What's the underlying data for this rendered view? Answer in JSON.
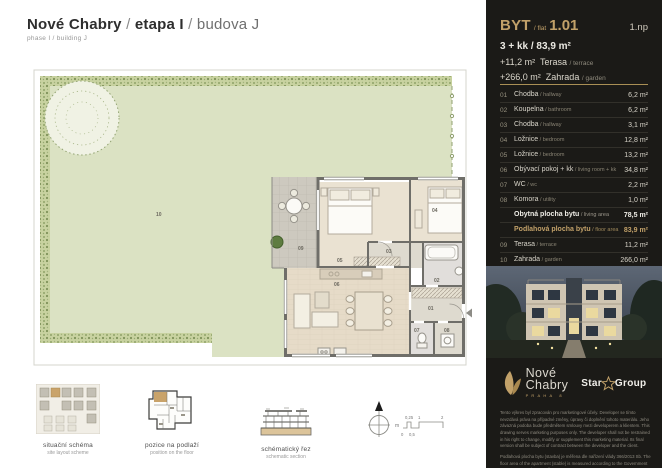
{
  "header": {
    "brand": "Nové Chabry",
    "sep": "/",
    "phase": "etapa I",
    "building": "budova J",
    "subtitle": "phase I / building J"
  },
  "plan": {
    "labels": {
      "r01": "01",
      "r02": "02",
      "r03": "03",
      "r04": "04",
      "r05": "05",
      "r06": "06",
      "r07": "07",
      "r08": "08",
      "r09": "09",
      "r10": "10"
    }
  },
  "diagrams": {
    "site": {
      "title": "situační schéma",
      "subtitle": "site layout scheme"
    },
    "floor": {
      "title": "pozice na podlaží",
      "subtitle": "position on the floor"
    },
    "section": {
      "title": "schématický řez",
      "subtitle": "schematic section"
    }
  },
  "scale": {
    "unit": "m",
    "top1": "0,25",
    "top2": "1",
    "top3": "2",
    "bot1": "0",
    "bot2": "0,5"
  },
  "panel": {
    "flat": {
      "byt": "BYT",
      "flat_label": "flat",
      "number": "1.01",
      "floor": "1.np",
      "layout": "3 + kk / 83,9 m²",
      "terrace_value": "+11,2 m²",
      "terrace_name": "Terasa",
      "terrace_en": "/ terrace",
      "garden_value": "+266,0 m²",
      "garden_name": "Zahrada",
      "garden_en": "/ garden"
    },
    "rooms": [
      {
        "num": "01",
        "cz": "Chodba",
        "en": "hallway",
        "area": "6,2 m²"
      },
      {
        "num": "02",
        "cz": "Koupelna",
        "en": "bathroom",
        "area": "6,2 m²"
      },
      {
        "num": "03",
        "cz": "Chodba",
        "en": "hallway",
        "area": "3,1 m²"
      },
      {
        "num": "04",
        "cz": "Ložnice",
        "en": "bedroom",
        "area": "12,8 m²"
      },
      {
        "num": "05",
        "cz": "Ložnice",
        "en": "bedroom",
        "area": "13,2 m²"
      },
      {
        "num": "06",
        "cz": "Obývací pokoj + kk",
        "en": "living room + kk",
        "area": "34,8 m²"
      },
      {
        "num": "07",
        "cz": "WC",
        "en": "wc",
        "area": "2,2 m²"
      },
      {
        "num": "08",
        "cz": "Komora",
        "en": "utility",
        "area": "1,0 m²"
      }
    ],
    "summary_living": {
      "cz": "Obytná plocha bytu",
      "en": "living area",
      "area": "78,5 m²"
    },
    "summary_floor": {
      "cz": "Podlahová plocha bytu",
      "en": "floor area",
      "area": "83,9 m²"
    },
    "outdoor": [
      {
        "num": "09",
        "cz": "Terasa",
        "en": "terrace",
        "area": "11,2 m²"
      },
      {
        "num": "10",
        "cz": "Zahrada",
        "en": "garden",
        "area": "266,0 m²"
      }
    ],
    "total": {
      "cz": "Celková plocha",
      "en": "total area",
      "area": "361,1 m²"
    },
    "logos": {
      "brand_line1": "Nové",
      "brand_line2": "Chabry",
      "brand_sub": "PRAHA 8",
      "partner_word1": "Star",
      "partner_word2": "Group"
    },
    "disclaimer1": "Tento výkres byl zpracován pro marketingové účely. Developer se tímto nevzdává práva na případné změny, úpravy či doplnění tohoto materiálu. Jeho závazná podoba bude předmětem smlouvy mezi developerem a klientem. This drawing serves marketing purposes only. The developer shall not be restrained in his right to change, modify or supplement this marketing material. Its final version shall be subject of contract between the developer and the client.",
    "disclaimer2": "Podlahová plocha bytu (stavba) je měřena dle nařízení vlády 366/2013 Sb. The floor area of the apartment (stable) is measured according to the Government Degree No. 366/2013 Coll."
  },
  "colors": {
    "gold": "#c2a169",
    "panel_bg": "#1b1a17",
    "garden_green": "#dbe2c3",
    "wall_gray": "#6f6e69"
  }
}
